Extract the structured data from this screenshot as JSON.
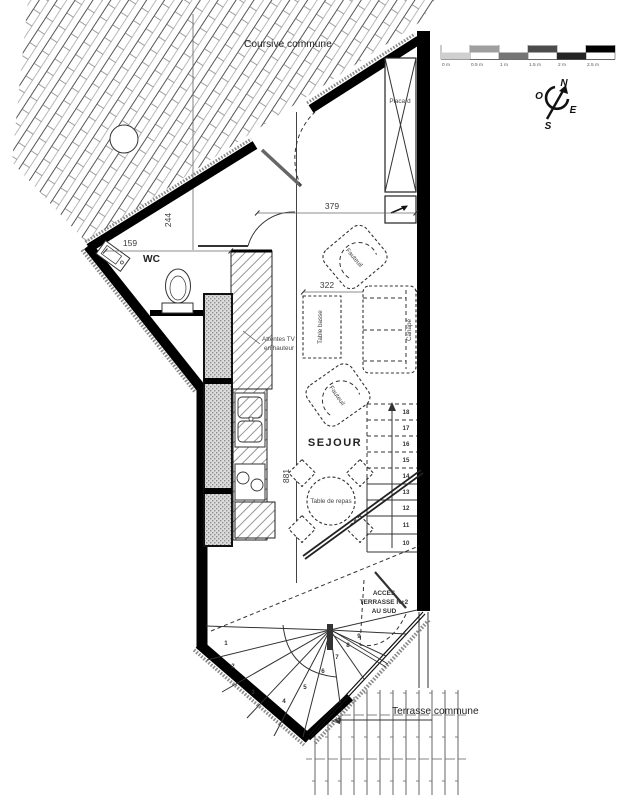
{
  "plan": {
    "areas": {
      "coursive": "Coursive commune",
      "terrasse": "Terrasse commune",
      "sejour": "SEJOUR",
      "wc": "WC"
    },
    "furniture": {
      "placard": "Placard",
      "fauteuil_top": "Fauteuil",
      "fauteuil_mid": "Fauteuil",
      "canape": "Canapé",
      "table_basse": "Table basse",
      "table_repas": "Table de repas"
    },
    "notes": {
      "tv_1": "Attentes TV",
      "tv_2": "en hauteur",
      "acces_1": "ACCES",
      "acces_2": "TERRASSE R+2",
      "acces_3": "AU SUD"
    },
    "dimensions": {
      "top_width": "379",
      "hall_height": "244",
      "wc_width": "159",
      "living_width": "322",
      "living_height": "881"
    },
    "stairs": {
      "treads": [
        "1",
        "2",
        "3",
        "4",
        "5",
        "6",
        "7",
        "8",
        "9",
        "10",
        "11",
        "12",
        "13",
        "14",
        "15",
        "16",
        "17",
        "18"
      ]
    },
    "scale_bar": {
      "labels": [
        "0 m",
        "0.5 m",
        "1 m",
        "1.5 m",
        "2 m",
        "2.5 m"
      ],
      "segment_colors": [
        "#cfcfcf",
        "#9f9f9f",
        "#757575",
        "#4c4c4c",
        "#242424",
        "#000000"
      ]
    },
    "compass": {
      "north": "N",
      "east": "E",
      "south": "S",
      "west": "O"
    },
    "colors": {
      "wall": "#000000",
      "stair_number": "#7b87a3",
      "annotation": "#333333"
    }
  }
}
